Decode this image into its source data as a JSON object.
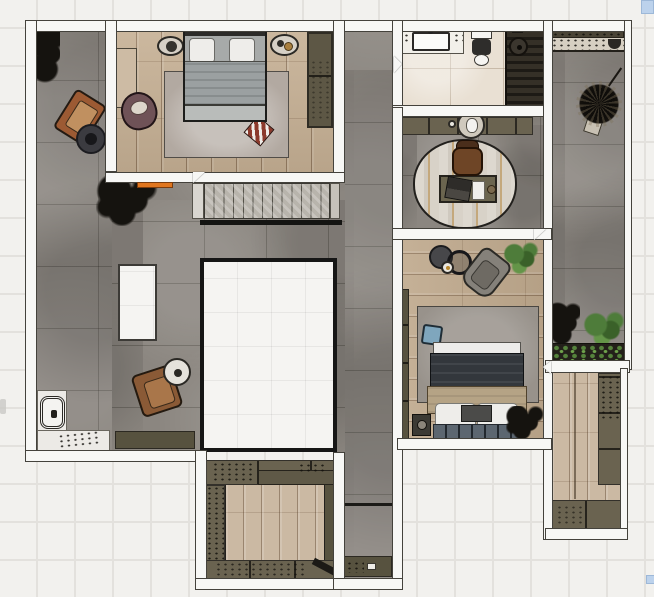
{
  "scene": {
    "type": "rendered-floor-plan-top-view",
    "rooms": [
      {
        "id": "bedroom-1",
        "floor": "wood"
      },
      {
        "id": "terrace-hall",
        "floor": "concrete"
      },
      {
        "id": "bathroom",
        "floor": "cream-tile"
      },
      {
        "id": "shower",
        "floor": "dark-slats"
      },
      {
        "id": "study-nook",
        "floor": "concrete"
      },
      {
        "id": "bedroom-2",
        "floor": "wood"
      },
      {
        "id": "balcony",
        "floor": "concrete"
      },
      {
        "id": "walk-in-closet",
        "floor": "wood"
      },
      {
        "id": "dressing-room",
        "floor": "wood-and-cabinets"
      },
      {
        "id": "stair-void",
        "floor": "open-to-below"
      }
    ],
    "furniture": [
      "double-bed-gray",
      "double-bed-dark",
      "orange-armchair",
      "brown-armchair",
      "mauve-armchair",
      "gray-armchair",
      "desk-with-laptop",
      "desk-chair",
      "bathtub-vanity",
      "toilet",
      "shower-fixture",
      "staircase",
      "wardrobes",
      "planters",
      "plants",
      "rugs",
      "side-tables",
      "ottoman"
    ]
  },
  "palette": {
    "background": "#f2f1ee",
    "grid_line": "#e3e1dd",
    "wall_fill": "#f7f7f5",
    "wall_line": "#44423c",
    "concrete": "#8b8680",
    "wood_warm": "#c6b094",
    "wood_light": "#cbb9a3",
    "tile_cream": "#e9e0d3",
    "slat_dark": "#1d1a15",
    "cabinet_olive": "#6a6350",
    "cabinet_olive_dark": "#57523f",
    "rug_gray": "#b2a9a1",
    "rug_gray_2": "#98928b",
    "duvet_gray": "#9ba0a1",
    "duvet_dark": "#33373c",
    "blanket_tan": "#b5a385",
    "pillow_white": "#eeedea",
    "leather_orange": "#9c5a33",
    "leather_brown": "#8a5a36",
    "chair_mauve": "#6f5257",
    "chair_gray": "#85817a",
    "plant_dark": "#15130f",
    "plant_green": "#4e7c3a",
    "accent_orange": "#e0761f",
    "cushion_blue": "#7fa6bd",
    "handle_blue": "#bcd2ec",
    "void_floor": "#f5f4f2",
    "headboard_blue": "#5c6670"
  },
  "artifacts": {
    "top_right_handle_color": "#bcd2ec",
    "bottom_right_handle_color": "#bcd2ec"
  }
}
